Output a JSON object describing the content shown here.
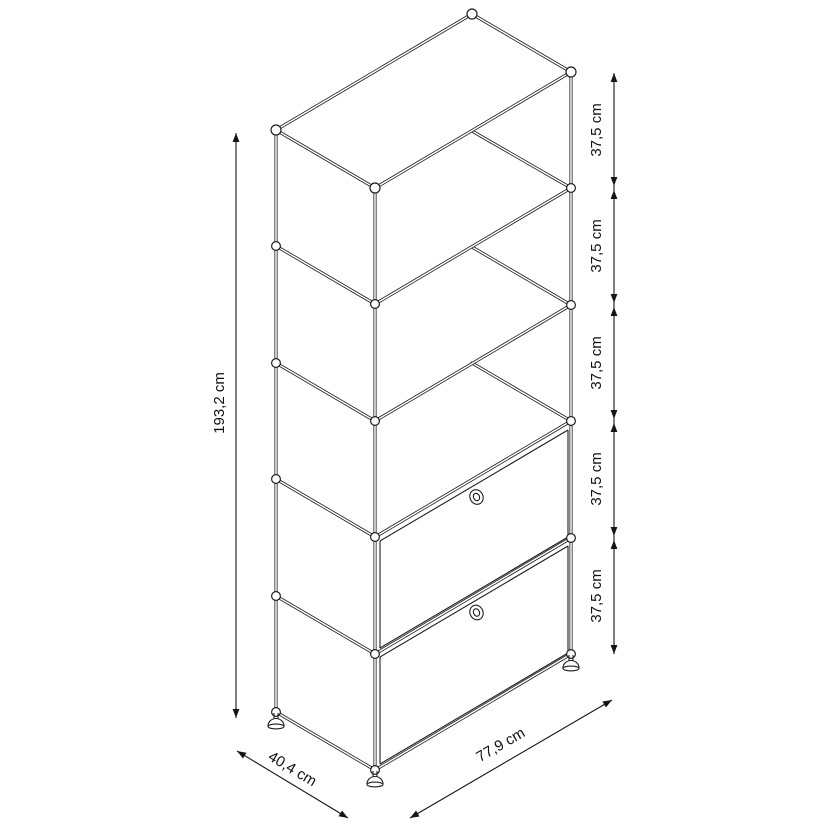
{
  "diagram": {
    "background": "#ffffff",
    "line_color": "#1e1e1e",
    "dimensions": {
      "total_height": "193,2 cm",
      "depth": "40,4 cm",
      "width": "77,9 cm",
      "segments": [
        "37,5 cm",
        "37,5 cm",
        "37,5 cm",
        "37,5 cm",
        "37,5 cm"
      ]
    }
  }
}
